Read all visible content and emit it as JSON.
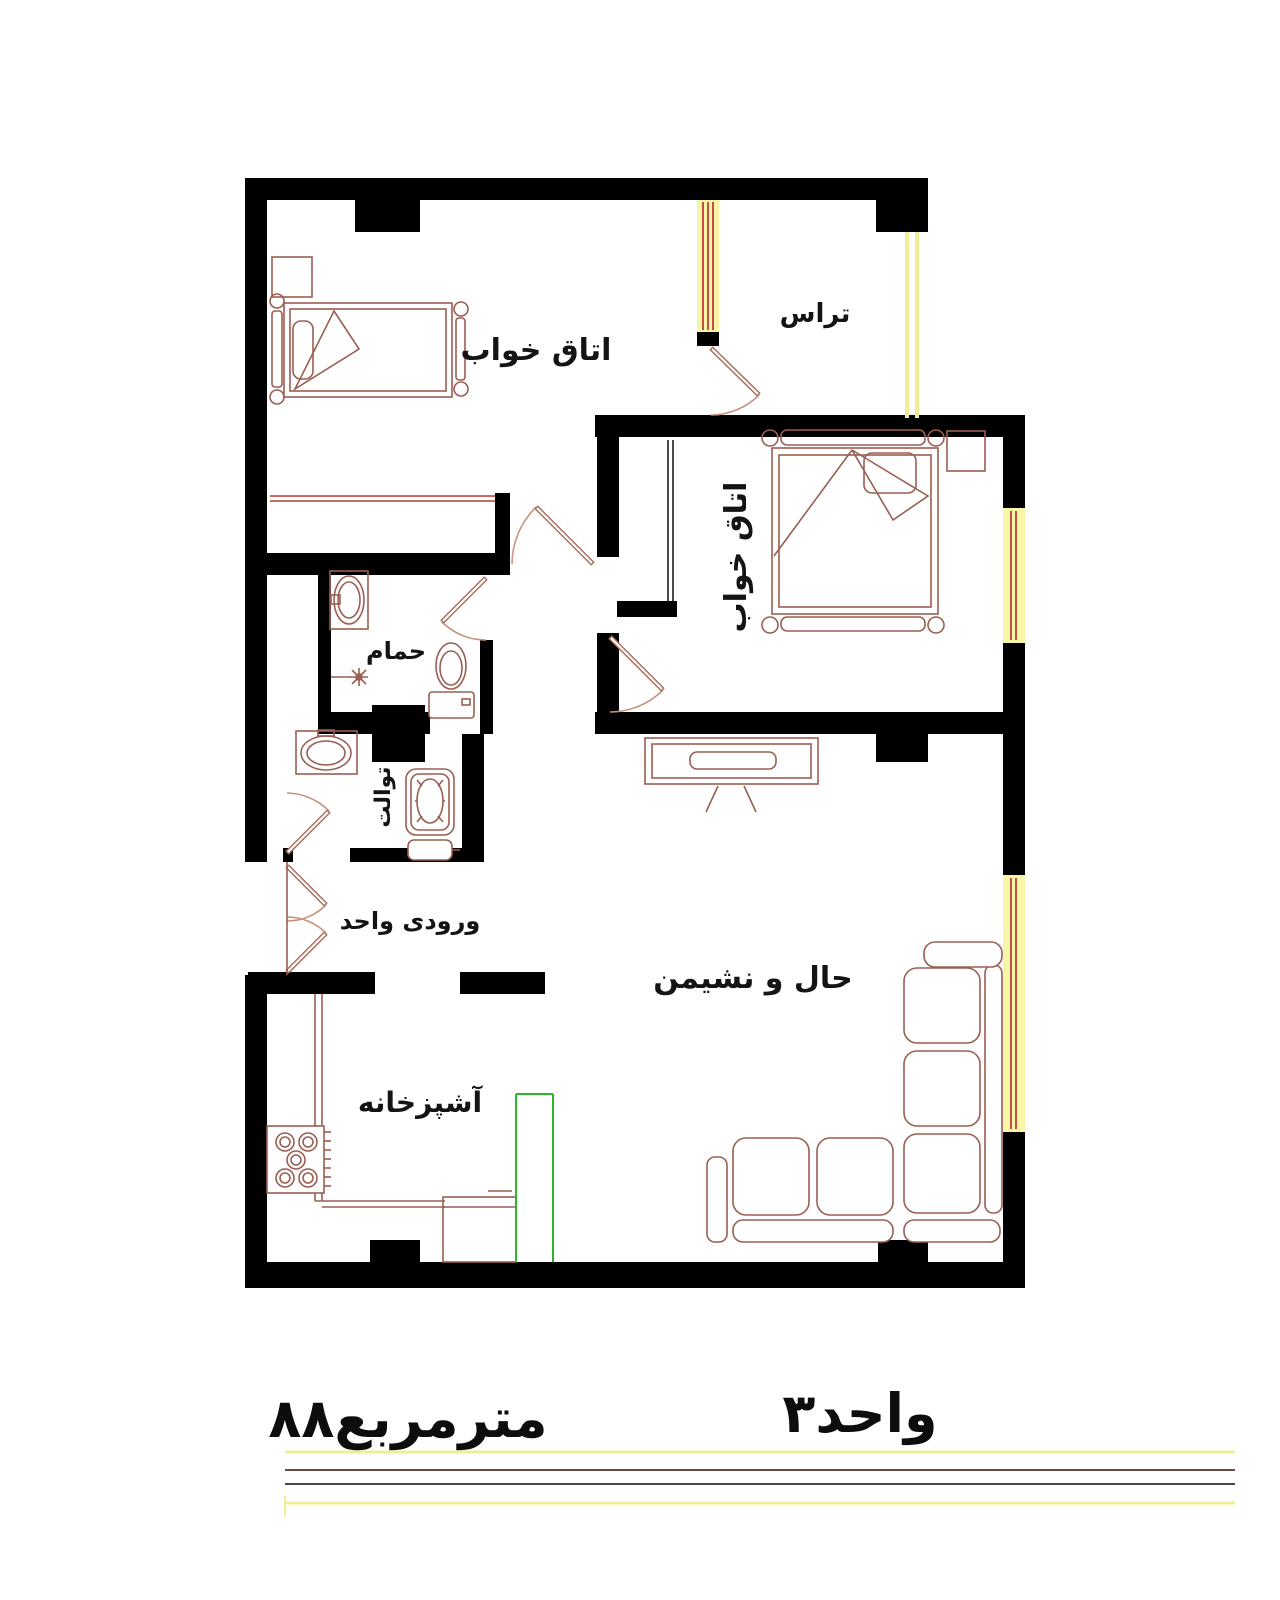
{
  "plan": {
    "rooms": {
      "bedroom_top": {
        "label": "اتاق خواب"
      },
      "terrace": {
        "label": "تراس"
      },
      "bedroom_right": {
        "label": "اتاق خواب"
      },
      "bathroom": {
        "label": "حمام"
      },
      "toilet": {
        "label": "توالت"
      },
      "entrance": {
        "label": "ورودی واحد"
      },
      "living": {
        "label": "حال و نشیمن"
      },
      "kitchen": {
        "label": "آشپزخانه"
      }
    },
    "footer": {
      "unit_label": "واحد۳",
      "area_label": "۸۸مترمربع"
    },
    "colors": {
      "wall": "#000000",
      "furniture_line": "#9a5e53",
      "door_leaf": "#a8705f",
      "window_glass": "#f6f6a6",
      "window_frame": "#c23b3b",
      "kitchen_counter_green": "#2db52d",
      "underline_yellow": "#efef92",
      "underline_maroon": "#6b4745",
      "background": "#ffffff"
    }
  }
}
